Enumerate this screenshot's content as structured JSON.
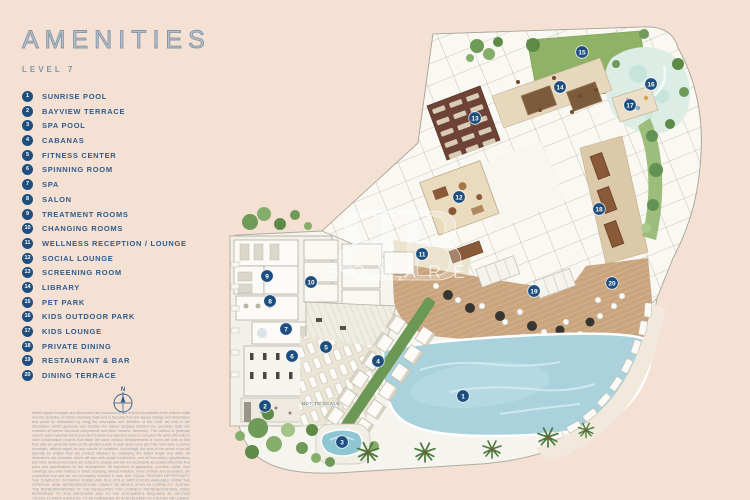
{
  "header": {
    "title": "AMENITIES",
    "level": "LEVEL 7"
  },
  "legend": {
    "items": [
      {
        "num": "1",
        "label": "SUNRISE POOL"
      },
      {
        "num": "2",
        "label": "BAYVIEW TERRACE"
      },
      {
        "num": "3",
        "label": "SPA POOL"
      },
      {
        "num": "4",
        "label": "CABANAS"
      },
      {
        "num": "5",
        "label": "FITNESS CENTER"
      },
      {
        "num": "6",
        "label": "SPINNING ROOM"
      },
      {
        "num": "7",
        "label": "SPA"
      },
      {
        "num": "8",
        "label": "SALON"
      },
      {
        "num": "9",
        "label": "TREATMENT ROOMS"
      },
      {
        "num": "10",
        "label": "CHANGING ROOMS"
      },
      {
        "num": "11",
        "label": "WELLNESS RECEPTION / LOUNGE"
      },
      {
        "num": "12",
        "label": "SOCIAL LOUNGE"
      },
      {
        "num": "13",
        "label": "SCREENING ROOM"
      },
      {
        "num": "14",
        "label": "LIBRARY"
      },
      {
        "num": "15",
        "label": "PET PARK"
      },
      {
        "num": "16",
        "label": "KIDS OUTDOOR PARK"
      },
      {
        "num": "17",
        "label": "KIDS LOUNGE"
      },
      {
        "num": "18",
        "label": "PRIVATE DINING"
      },
      {
        "num": "19",
        "label": "RESTAURANT & BAR"
      },
      {
        "num": "20",
        "label": "DINING TERRACE"
      }
    ]
  },
  "plan": {
    "watermark": {
      "monogram": "B",
      "text": "BOMARE"
    },
    "markers": [
      {
        "num": "1",
        "x": 463,
        "y": 396
      },
      {
        "num": "2",
        "x": 265,
        "y": 406
      },
      {
        "num": "3",
        "x": 342,
        "y": 442
      },
      {
        "num": "4",
        "x": 378,
        "y": 361
      },
      {
        "num": "5",
        "x": 326,
        "y": 347
      },
      {
        "num": "6",
        "x": 292,
        "y": 356
      },
      {
        "num": "7",
        "x": 286,
        "y": 329
      },
      {
        "num": "8",
        "x": 270,
        "y": 301
      },
      {
        "num": "9",
        "x": 267,
        "y": 276
      },
      {
        "num": "10",
        "x": 311,
        "y": 282
      },
      {
        "num": "11",
        "x": 422,
        "y": 254
      },
      {
        "num": "12",
        "x": 459,
        "y": 197
      },
      {
        "num": "13",
        "x": 475,
        "y": 118
      },
      {
        "num": "14",
        "x": 560,
        "y": 87
      },
      {
        "num": "15",
        "x": 582,
        "y": 52
      },
      {
        "num": "16",
        "x": 651,
        "y": 84
      },
      {
        "num": "17",
        "x": 630,
        "y": 105
      },
      {
        "num": "18",
        "x": 599,
        "y": 209
      },
      {
        "num": "19",
        "x": 534,
        "y": 291
      },
      {
        "num": "20",
        "x": 612,
        "y": 283
      }
    ]
  },
  "footer": {
    "compass_label": "N",
    "scale_note": "NOT TO SCALE",
    "disclaimer": "Stated square footages and dimensions are measured to the exterior boundaries of the exterior walls and the centerline of interior demising walls and in fact vary from the square footage and dimensions that would be determined by using the description and definition of the \"Unit\" set forth in the Declaration (which generally only includes the interior airspace between the perimeter walls and excludes all interior structural components and other common elements). This method is generally used in sales materials and is provided to allow a prospective buyer to compare the Units with units in other condominium projects that utilize the same method. Measurements of rooms set forth on this floor plan are generally taken at the greatest points of each given room (as if the room were a perfect rectangle), without regard for any cutouts or variations. Accordingly, the area of the actual room will typically be smaller than the product obtained by multiplying the stated length and width. All dimensions are estimates which will vary with actual construction, and all floor plans, specifications and other development plans are subject to change and will not necessarily accurately reflect the final plans and specifications for the development. All depictions of appliances, counters, soffits, floor coverings and other matters of detail, including, without limitation, items of finish and decoration, are conceptual only and are not necessarily included in each Unit. EQUAL HOUSING OPPORTUNITY. THE COMPLETE OFFERING TERMS ARE IN A CPS-12 APPLICATION AVAILABLE FROM THE OFFEROR. ORAL REPRESENTATIONS CANNOT BE RELIED UPON AS CORRECTLY STATING THE REPRESENTATIONS OF THE DEVELOPER. FOR CORRECT REPRESENTATIONS, MAKE REFERENCE TO THIS BROCHURE AND TO THE DOCUMENTS REQUIRED BY SECTION 718.503, FLORIDA STATUTES, TO BE FURNISHED BY A DEVELOPER TO A BUYER OR LESSEE. This advertisement is a solicitation for the sale of Units in the Condominium. Registration No. CD-24-0000."
  },
  "colors": {
    "background": "#f5e1d3",
    "marker": "#1d4e7d",
    "legend_text": "#2f5c8c",
    "title": "#7e97ab",
    "plan_base": "#f6f4ef",
    "pool": "#a9d2dc",
    "lawn": "#8fb267",
    "deck": "#c9a47d",
    "screening_room": "#6e4335",
    "kids_park": "#dcede6"
  }
}
